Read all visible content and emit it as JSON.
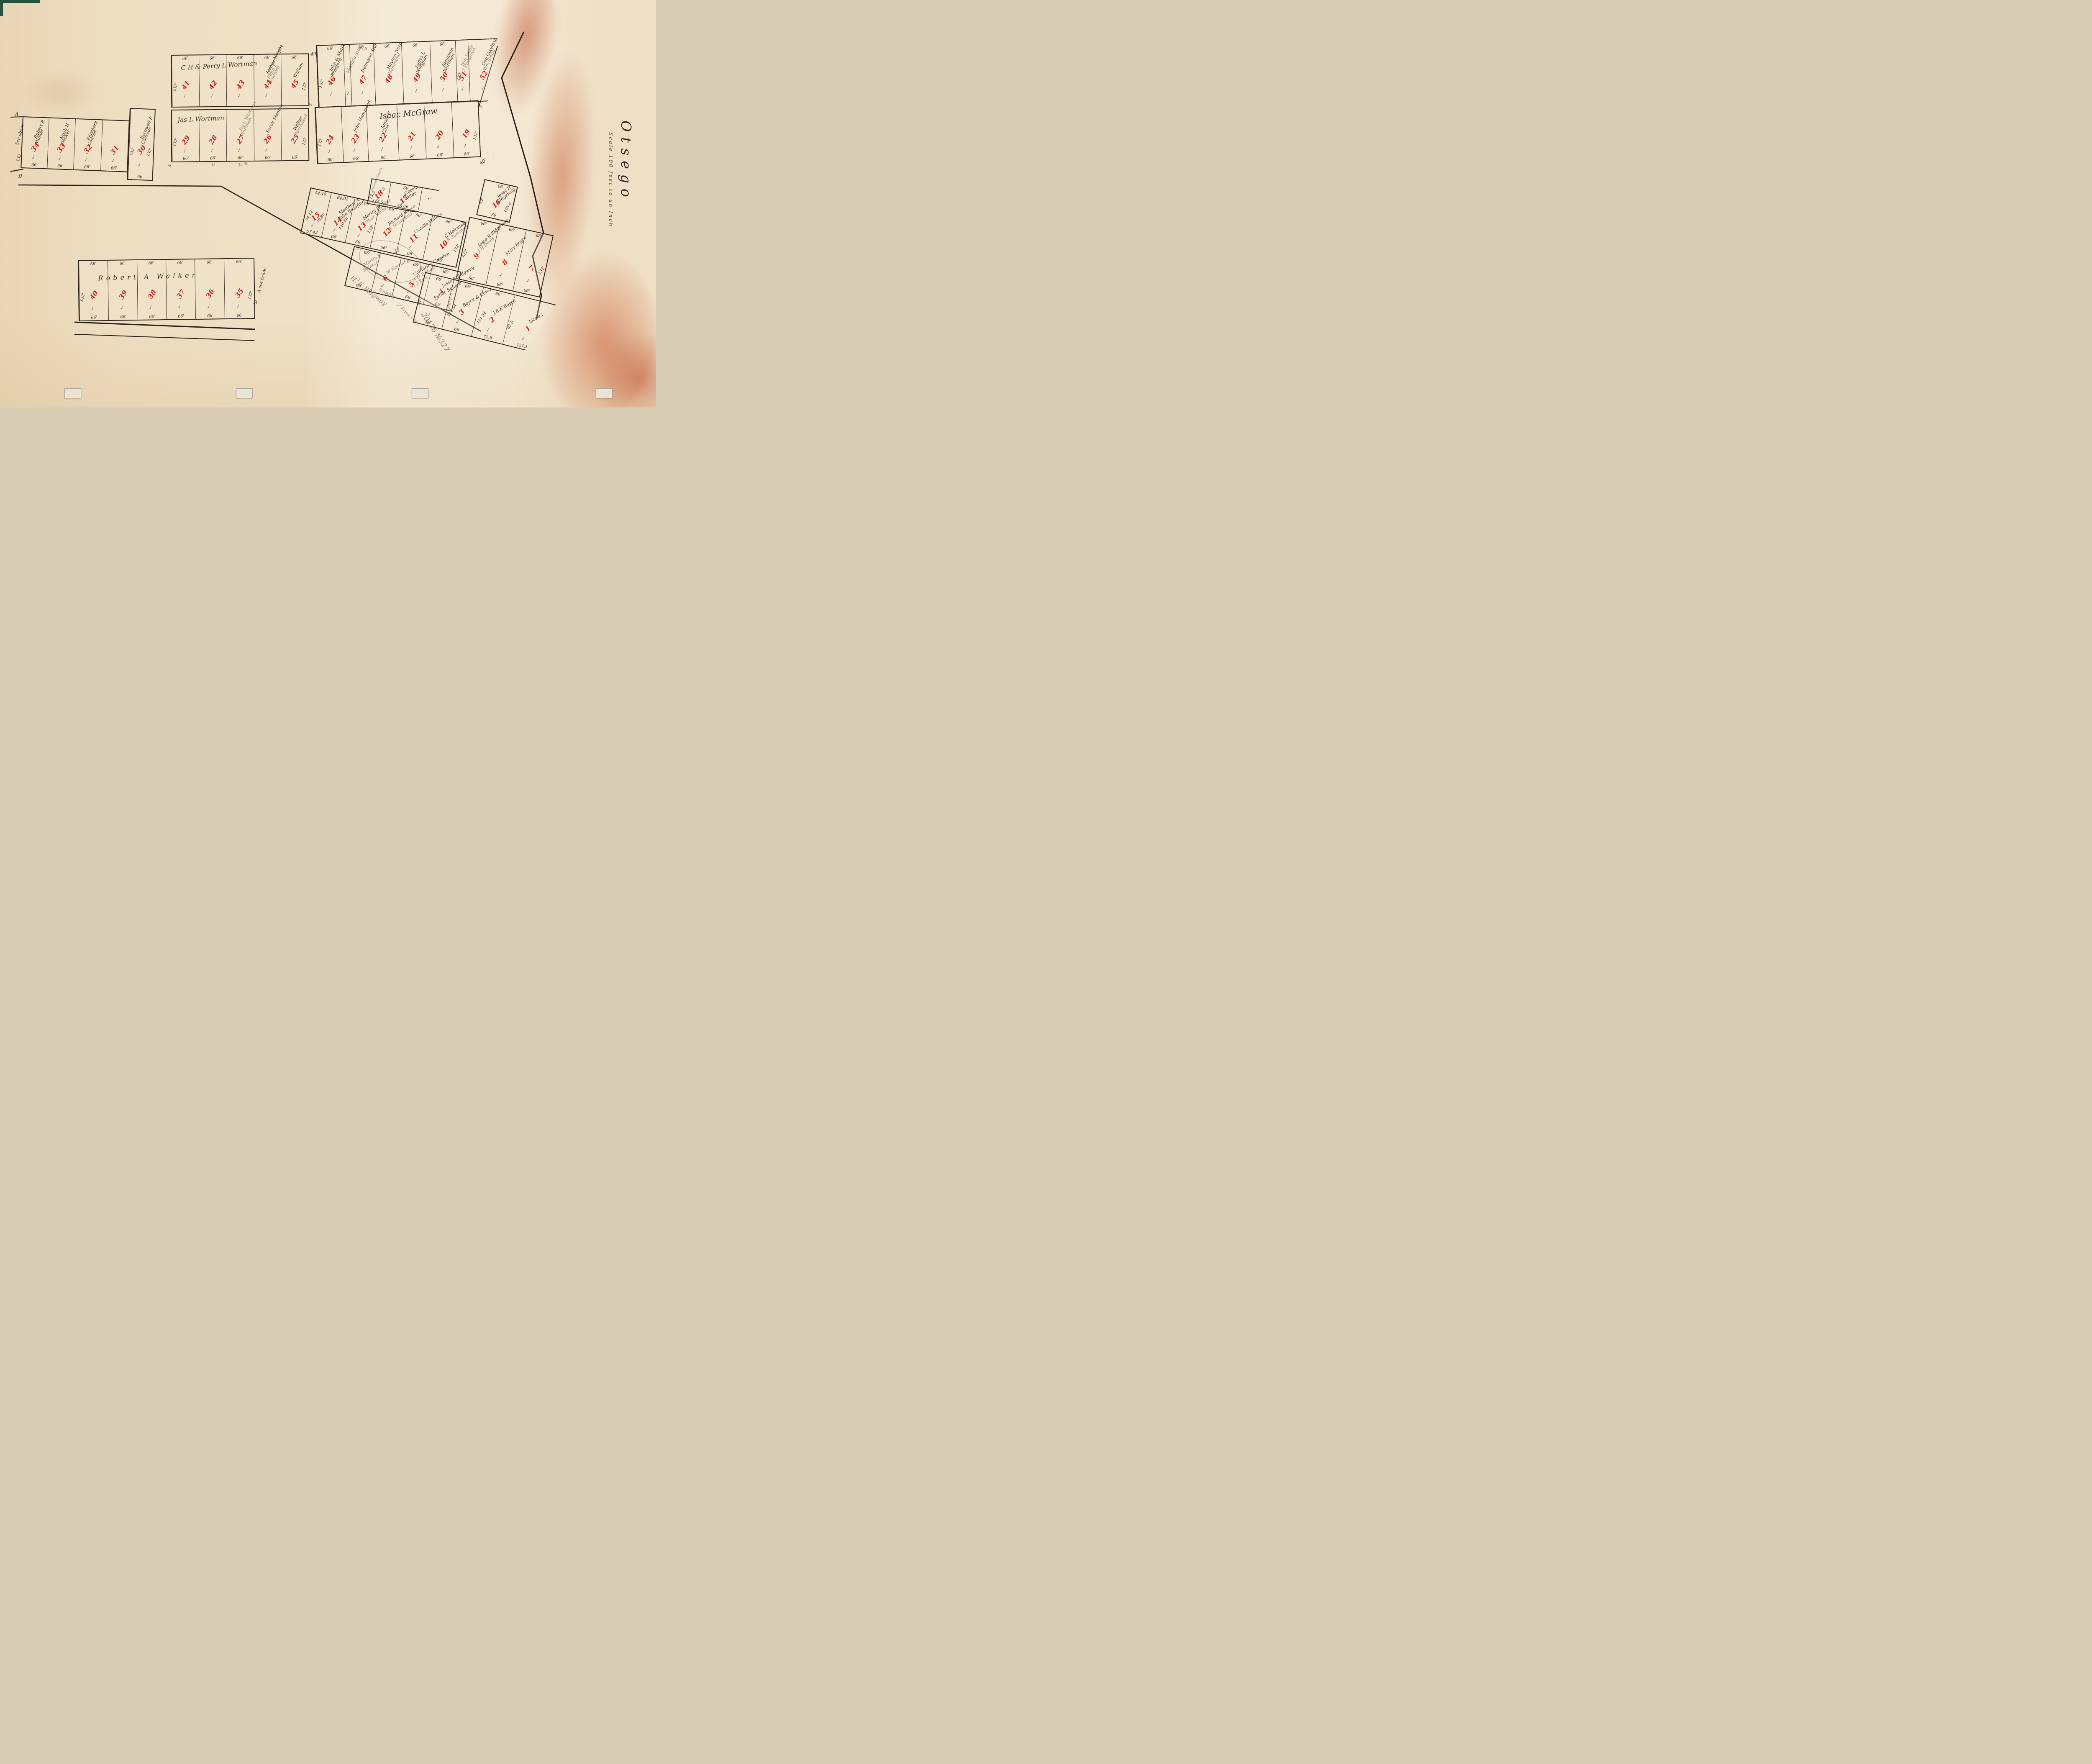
{
  "palette": {
    "paper": "#efe0c5",
    "ink": "#3b2e20",
    "red": "#c42420",
    "pencil": "#8b8172",
    "line": "#2e2418",
    "stain": "#b9502d"
  },
  "title": {
    "name": "Otsego",
    "scale": "Scale 100 feet to an Inch"
  },
  "blocks": [
    {
      "id": "A",
      "label": "C H & Perry L Wortman",
      "left_dim": "132'",
      "right_dim": "132'",
      "lots": [
        {
          "num": "41",
          "top": "66'",
          "check": true
        },
        {
          "num": "42",
          "top": "66'",
          "check": true
        },
        {
          "num": "43",
          "top": "66'",
          "check": true
        },
        {
          "num": "44",
          "top": "66'",
          "struck": [
            "Joshua Wright"
          ],
          "pencil": [
            "Flora J",
            "Bradford"
          ],
          "check": true
        },
        {
          "num": "45",
          "top": "66'",
          "names": [
            "William"
          ],
          "check": false
        }
      ]
    },
    {
      "id": "B",
      "left_dim": "132'",
      "lots": [
        {
          "num": "46",
          "top": "66'",
          "names": [
            "John & Matilda",
            "Bradford"
          ],
          "check": true
        },
        {
          "strip": true,
          "pencil": [
            "Malinda Sturtz"
          ],
          "check": true
        },
        {
          "num": "47",
          "top": "66'",
          "names": [
            "Dennison Sturtz"
          ],
          "check": true
        },
        {
          "num": "48",
          "top": "66'",
          "names": [
            "Haynes Norris"
          ],
          "pencil": [
            "Hammond"
          ],
          "check": false
        },
        {
          "num": "49",
          "top": "66'",
          "names": [
            "James L",
            "Wortman"
          ],
          "check": true
        },
        {
          "num": "50",
          "top": "66'",
          "names": [
            "Benjamin",
            "Wortman"
          ],
          "check": true
        },
        {
          "num": "51",
          "left": "132'",
          "pencil": [
            "Wm Smith",
            "2 Pinkerton"
          ],
          "check": true
        },
        {
          "num": "52",
          "names": [
            "Geo Goodhart"
          ],
          "pencil": [
            "Wm Smith"
          ],
          "right": "143'",
          "check": true
        }
      ]
    },
    {
      "id": "C",
      "label": "Jas L Wortman",
      "left_dim": "132'",
      "right_dim": "132'",
      "lots": [
        {
          "num": "29",
          "bottom": "66'",
          "check": true
        },
        {
          "num": "28",
          "bottom": "66'",
          "check": true,
          "note_below": "33"
        },
        {
          "num": "27",
          "bottom": "66'",
          "pencil": [
            "Jas L Wortman",
            "Wortman"
          ],
          "check": true,
          "note_below": "33 66"
        },
        {
          "num": "26",
          "bottom": "66'",
          "names": [
            "Sarah Stanton"
          ],
          "check": true
        },
        {
          "num": "25",
          "bottom": "66'",
          "names": [
            "Walker"
          ],
          "pencil": [
            "Purchased"
          ],
          "check": false
        }
      ]
    },
    {
      "id": "D",
      "label": "Isaac McGraw",
      "left_dim": "132'",
      "right_dim": "132'",
      "lots": [
        {
          "num": "24",
          "bottom": "66'",
          "check": true
        },
        {
          "num": "23",
          "bottom": "66'",
          "names": [
            "John Hammond"
          ],
          "check": true
        },
        {
          "num": "22",
          "bottom": "66'",
          "names": [
            "James F",
            "Case"
          ],
          "check": true
        },
        {
          "num": "21",
          "bottom": "66'",
          "check": true
        },
        {
          "num": "20",
          "bottom": "66'",
          "check": true
        },
        {
          "num": "19",
          "bottom": "66'",
          "check": true
        }
      ]
    },
    {
      "id": "E",
      "lots": [
        {
          "num": "34",
          "bottom": "66'",
          "names": [
            "Robert R",
            "Walker"
          ],
          "check": true
        },
        {
          "num": "33",
          "bottom": "66'",
          "names": [
            "Noah H",
            "Decker"
          ],
          "check": true
        },
        {
          "num": "32",
          "bottom": "66'",
          "names": [
            "Elizabeth",
            "Conrad"
          ],
          "check": true
        },
        {
          "num": "31",
          "bottom": "66'",
          "check": true
        }
      ]
    },
    {
      "id": "E30",
      "left_dim": "132'",
      "right_dim": "132'",
      "lots": [
        {
          "num": "30",
          "bottom": "66'",
          "names": [
            "Barnwell F",
            "Conrade"
          ],
          "check": true
        }
      ]
    },
    {
      "id": "F",
      "label": "Robert A Walker",
      "left_dim": "132'",
      "right_dim": "132'",
      "lots": [
        {
          "num": "40",
          "top": "66'",
          "bottom": "66'",
          "check": true
        },
        {
          "num": "39",
          "top": "66'",
          "bottom": "66'",
          "check": true
        },
        {
          "num": "38",
          "top": "66'",
          "bottom": "66'",
          "check": true
        },
        {
          "num": "37",
          "top": "66'",
          "bottom": "66'",
          "check": true
        },
        {
          "num": "36",
          "top": "66'",
          "bottom": "66'",
          "check": true
        },
        {
          "num": "35",
          "top": "66'",
          "bottom": "66'",
          "check": true
        }
      ]
    },
    {
      "id": "G",
      "lots": [
        {
          "num": "15",
          "top": "54.48",
          "left": "54.12",
          "right": "79.86",
          "bottom": "57.42",
          "check": true
        },
        {
          "num": "14",
          "top": "64.02",
          "right": "110.88",
          "bottom": "66'",
          "names": [
            "Matthew A",
            "John Bradford"
          ],
          "check": true
        },
        {
          "num": "13",
          "top": "66",
          "right": "132'",
          "bottom": "66'",
          "names": [
            "Martin Bainter"
          ],
          "pencil": [
            "arthur Walker"
          ],
          "check": true,
          "note_below": "33"
        },
        {
          "num": "12",
          "top": "66'",
          "bottom": "66'",
          "names": [
            "Richard Boyce"
          ],
          "pencil": [
            "W Hammond"
          ],
          "check": false
        },
        {
          "num": "11",
          "top": "66'",
          "bottom": "66'",
          "names": [
            "Cecelia Waters"
          ],
          "check": true
        },
        {
          "num": "10",
          "top": "66'",
          "right": "132'",
          "bottom": "66'",
          "names": [
            "C Holcomb"
          ],
          "pencil": [
            "J R Summers"
          ],
          "check": false
        }
      ]
    },
    {
      "id": "H",
      "lots": [
        {
          "num": "18",
          "left": "15.5",
          "bottom": "115.5",
          "pencil": [
            "+9"
          ],
          "check": true
        },
        {
          "num": "17",
          "top": "66",
          "bottom": "36  66",
          "names": [
            "Cecelia A",
            "Water"
          ],
          "check": true
        },
        {
          "names": [
            "Jas E Case"
          ],
          "right": "82.5",
          "check": true
        }
      ]
    },
    {
      "id": "I",
      "lots": [
        {
          "num": "16",
          "top": "66",
          "left": "99'",
          "right": "105.6",
          "bottom": "66",
          "names": [
            "Jesse R",
            "Ridgeway"
          ],
          "check": false
        }
      ]
    },
    {
      "id": "J",
      "lots": [
        {
          "num": "9",
          "top": "66'",
          "left": "132'",
          "bottom": "66'",
          "names": [
            "Jesse R Ridgeway"
          ],
          "pencil": [
            "J H Davis"
          ],
          "check": false
        },
        {
          "num": "8",
          "top": "66'",
          "bottom": "66'",
          "names": [
            "Mary Boyce"
          ],
          "check": true
        },
        {
          "num": "7",
          "top": "66'",
          "right": "132'",
          "bottom": "66'",
          "check": true
        }
      ]
    },
    {
      "id": "K",
      "lots": [
        {
          "top": "66'",
          "bottom": "66'",
          "pencil": [
            "Martin R",
            "Bainter"
          ],
          "check": true
        },
        {
          "num": "6",
          "pencil": [
            "M Norris"
          ],
          "check": true
        },
        {
          "num": "5",
          "top": "66'",
          "bottom": "66'",
          "names": [
            "Catharine Cowden"
          ],
          "pencil": [
            "A H P Hagar",
            "T J Russ"
          ],
          "check": true
        },
        {
          "num": "4",
          "top": "66'",
          "bottom": "66'",
          "names": [
            "Jesse R Ridgway"
          ],
          "check": true
        }
      ]
    },
    {
      "id": "L",
      "lots": [
        {
          "names": [
            "Public Square"
          ],
          "top": "60'",
          "left": "99'",
          "bottom": "60'",
          "check": true
        },
        {
          "num": "3",
          "top": "66'",
          "left": "111.54",
          "bottom": "66'",
          "names": [
            "Boyce & Cowden"
          ],
          "check": true
        },
        {
          "num": "2",
          "top": "66'",
          "left": "111.54",
          "bottom": "72.6",
          "names": [
            "J.E.K Boyce"
          ],
          "check": true
        },
        {
          "num": "1",
          "left": "82.5",
          "top": "138.6",
          "bottom": "151.14",
          "names": [
            "Lizzie Nelson"
          ],
          "check": true
        }
      ]
    }
  ],
  "margins": {
    "e_top": "A",
    "e_side": "See above",
    "e_dim": "132",
    "e_bottom": "B",
    "f_side": "A see below",
    "f_bottom": "B"
  },
  "annotations": [
    {
      "text": "40'",
      "kind": "ink"
    },
    {
      "text": "40'",
      "kind": "ink"
    },
    {
      "text": "18",
      "kind": "pencil"
    },
    {
      "text": "not",
      "kind": "pencil"
    },
    {
      "text": "22",
      "kind": "pencil"
    },
    {
      "text": "+6",
      "kind": "pencil"
    },
    {
      "text": "8",
      "kind": "pencil"
    },
    {
      "text": "H. F. Ridgway",
      "kind": "pencil"
    },
    {
      "text": "2' Front x 66'",
      "kind": "pencil"
    },
    {
      "text": "20136 №327",
      "kind": "pencil"
    },
    {
      "text": "Omro",
      "kind": "pencil"
    },
    {
      "text": "cowden",
      "kind": "pencil"
    },
    {
      "text": "Malinda Sturtz",
      "kind": "pencil"
    },
    {
      "text": "5",
      "kind": "ink"
    },
    {
      "text": "5",
      "kind": "ink"
    },
    {
      "text": "5",
      "kind": "ink"
    }
  ]
}
